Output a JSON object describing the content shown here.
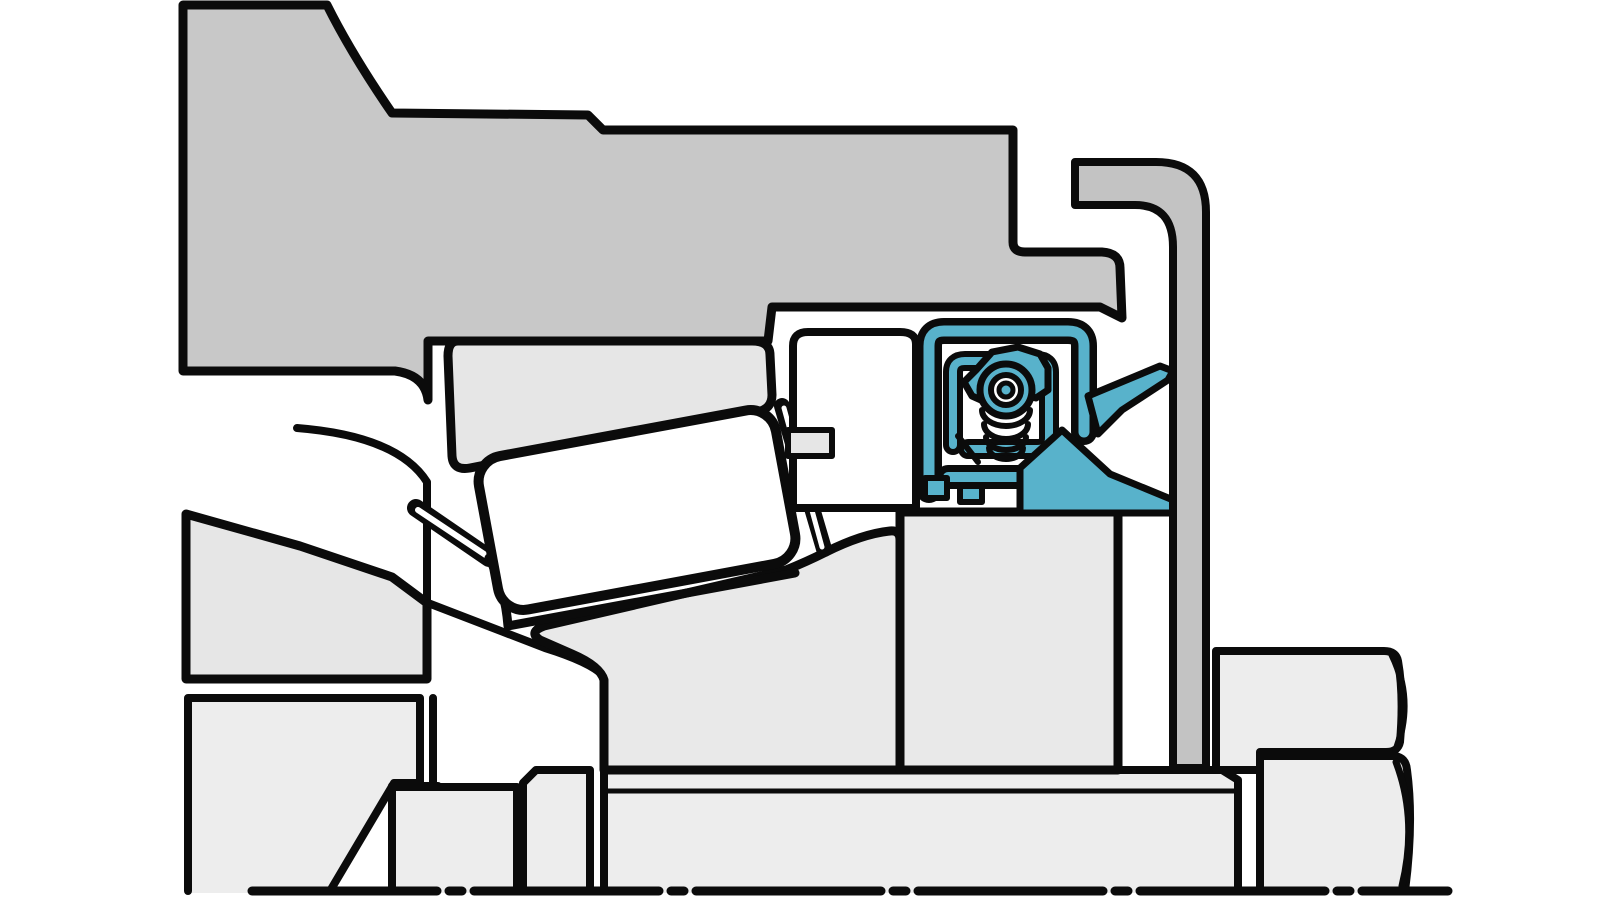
{
  "figure": {
    "title": "Cross-section diagram of a tapered roller bearing arrangement with a radial shaft seal and slinger",
    "type": "technical-illustration",
    "text_labels": []
  },
  "colors": {
    "background": "#ffffff",
    "outline": "#0b0b0b",
    "housing_gray": "#c8c8c8",
    "cover_gray": "#c3c3c3",
    "part_light": "#ededed",
    "ring_gray": "#e6e6e6",
    "cone_gray": "#e9e9e9",
    "white": "#ffffff",
    "seal": "#58b2cb"
  },
  "parts": {
    "housing": "Housing / hub",
    "end_cover": "End cover wedge",
    "outer_ring": "Bearing outer ring (cup)",
    "roller": "Tapered roller",
    "cage": "Roller cage",
    "inner_ring": "Bearing inner ring (cone) with big-end rib",
    "counterface": "Seal counterface sleeve",
    "seal_unit": "Radial shaft seal with garter spring (highlighted)",
    "slinger": "Slinger / V-ring arms",
    "cover_plate": "Bent sheet cover plate",
    "shaft": "Shaft with stepped sleeve sections",
    "locknut": "Shaft locknut and washer blocks",
    "centerline": "Shaft centerline"
  }
}
